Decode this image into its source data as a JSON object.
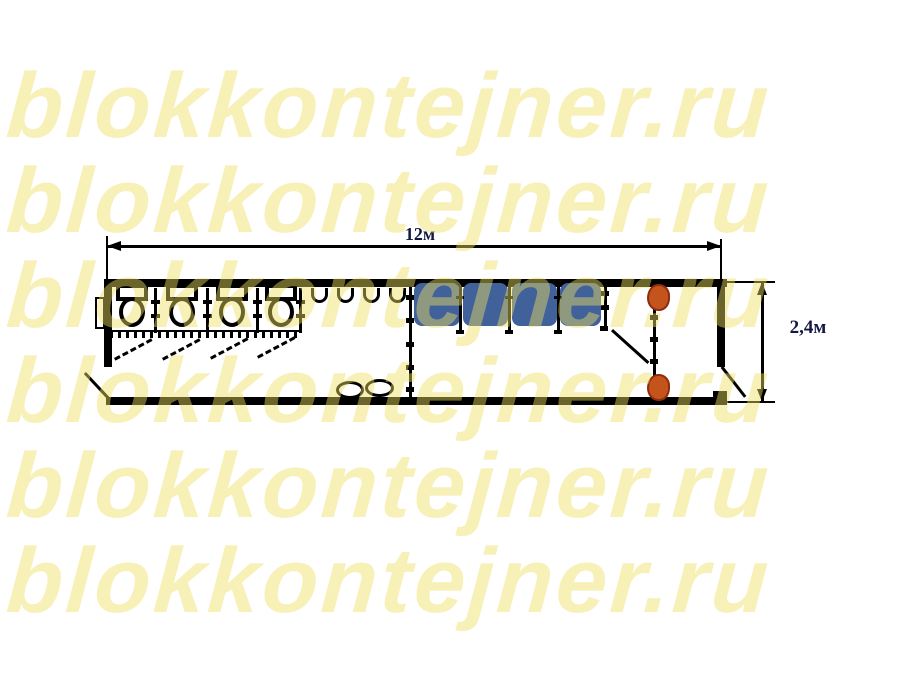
{
  "watermark": {
    "text": "blokkontejner.ru",
    "rows": 6,
    "color": "rgba(238,222,95,0.45)"
  },
  "plan": {
    "title": "blok-container floor plan 12m x 2.4m",
    "length_label": "12м",
    "width_label": "2,4м",
    "colors": {
      "line": "#000000",
      "shower_cabin_fill": "#41619B",
      "heater_fill": "#C4541C",
      "heater_border": "#8E2D0E",
      "dimension_text": "#141743",
      "watermark_yellow": "rgba(238,222,95,0.45)"
    },
    "fixtures": {
      "toilet_stalls": 4,
      "toilets": 4,
      "wall_hooks": 4,
      "shower_cabins": 4,
      "washbasins": 2,
      "heaters": 2,
      "doors": 4
    }
  }
}
